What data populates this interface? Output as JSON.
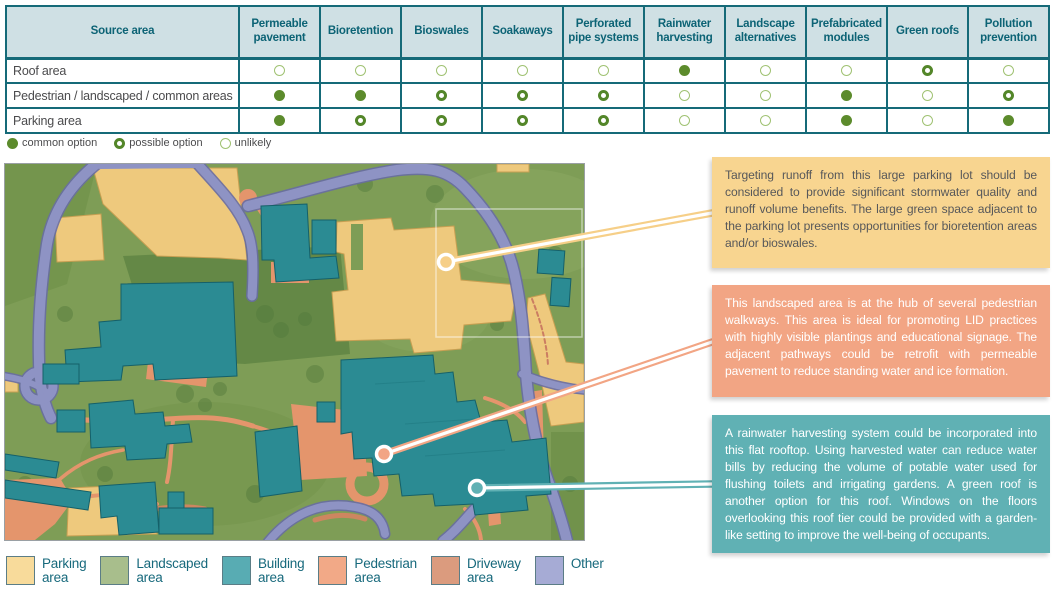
{
  "table": {
    "source_col_header": "Source area",
    "columns": [
      "Permeable pavement",
      "Bioretention",
      "Bioswales",
      "Soakaways",
      "Perforated pipe systems",
      "Rainwater harvesting",
      "Landscape alternatives",
      "Prefabricated modules",
      "Green roofs",
      "Pollution prevention"
    ],
    "rows": [
      {
        "label": "Roof area",
        "values": [
          "u",
          "u",
          "u",
          "u",
          "u",
          "c",
          "u",
          "u",
          "p",
          "u"
        ]
      },
      {
        "label": "Pedestrian / landscaped / common areas",
        "values": [
          "c",
          "c",
          "p",
          "p",
          "p",
          "u",
          "u",
          "c",
          "u",
          "p"
        ]
      },
      {
        "label": "Parking area",
        "values": [
          "c",
          "p",
          "p",
          "p",
          "p",
          "u",
          "u",
          "c",
          "u",
          "c"
        ]
      }
    ],
    "symbol_legend": [
      {
        "symbol": "c",
        "label": "common option"
      },
      {
        "symbol": "p",
        "label": "possible option"
      },
      {
        "symbol": "u",
        "label": "unlikely"
      }
    ]
  },
  "callouts": [
    {
      "id": "parking-lot",
      "color": "#f8d590",
      "leader_color": "#f6cf88",
      "text_color": "#57585a",
      "text": "Targeting runoff from this large parking lot should be considered to provide significant stormwater quality and runoff volume benefits. The large green space adjacent to the parking lot presents opportunities for bioretention areas and/or bioswales."
    },
    {
      "id": "landscaped-hub",
      "color": "#f2a584",
      "leader_color": "#f2a584",
      "text_color": "#ffffff",
      "text": "This landscaped area is at the hub of several pedestrian walkways. This area is ideal for promoting LID practices with highly visible plantings and educational signage. The adjacent pathways could be retrofit with permeable pavement to reduce standing water and ice formation."
    },
    {
      "id": "flat-rooftop",
      "color": "#60b1b4",
      "leader_color": "#60b1b4",
      "text_color": "#ffffff",
      "text": "A rainwater harvesting system could be incorporated into this flat rooftop. Using harvested water can reduce water bills by reducing the volume of potable water used for flushing toilets and irrigating gardens. A green roof is another option for this roof. Windows on the floors overlooking this roof tier could be provided with a garden-like setting to improve the well-being of occupants."
    }
  ],
  "map_legend": [
    {
      "lines": [
        "Parking",
        "area"
      ],
      "color": "#f8db9b"
    },
    {
      "lines": [
        "Landscaped",
        "area"
      ],
      "color": "#a8be8c"
    },
    {
      "lines": [
        "Building",
        "area"
      ],
      "color": "#58acb3"
    },
    {
      "lines": [
        "Pedestrian",
        "area"
      ],
      "color": "#f2a987"
    },
    {
      "lines": [
        "Driveway",
        "area"
      ],
      "color": "#db9b7e"
    },
    {
      "lines": [
        "Other"
      ],
      "color": "#a6abd5"
    }
  ],
  "colors": {
    "table_header_bg": "#cfe0e4",
    "table_border": "#156a78",
    "table_header_text": "#0c6375",
    "body_text": "#4b4b4d",
    "dot_common": "#5c8b2c",
    "dot_possible": "#538629",
    "dot_unlikely": "#a0c273",
    "legend_label_text": "#17697c",
    "map_road": "#8e93c4",
    "map_building": "#2b8b93",
    "map_parking": "#eec97d",
    "map_pedestrian": "#e4956c",
    "map_landscaped": "#7e9d56"
  }
}
